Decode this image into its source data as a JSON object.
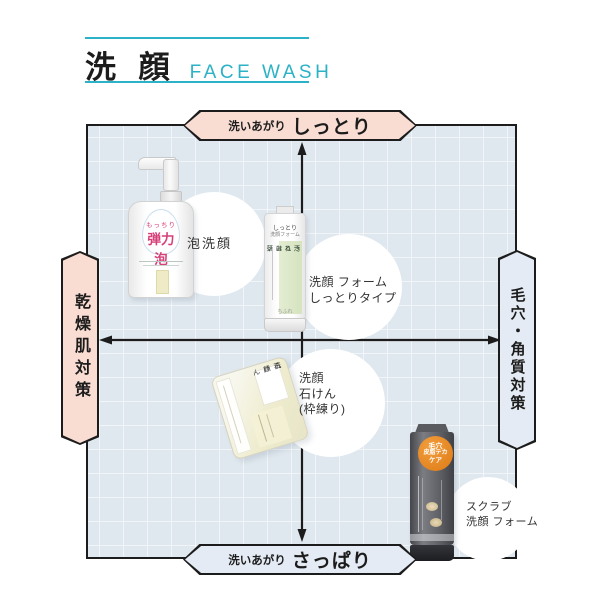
{
  "colors": {
    "accent_teal": "#2bb2c6",
    "banner_pink": "#f9dcd2",
    "banner_blue": "#e4ebf4",
    "grid_bg": "#e0e8ef",
    "ink": "#1c1c1c",
    "product_magenta": "#d64078",
    "tube_green": "#d5e3bf",
    "tube_dark": "#5a5c61",
    "badge_orange": "#e8882a"
  },
  "header": {
    "title_ja": "洗 顔",
    "title_en": "FACE WASH"
  },
  "quadrant": {
    "top": {
      "prefix": "洗いあがり",
      "label": "しっとり"
    },
    "bottom": {
      "prefix": "洗いあがり",
      "label": "さっぱり"
    },
    "left": {
      "label": "乾燥肌対策"
    },
    "right": {
      "label": "毛穴・角質対策"
    }
  },
  "products": [
    {
      "name": "foam-face-wash",
      "annotation": [
        "泡洗顔"
      ],
      "package": {
        "line_small": "もっちり",
        "line_big": "弾力泡"
      }
    },
    {
      "name": "face-wash-foam-moist-type",
      "annotation": [
        "洗顔 フォーム",
        "しっとりタイプ"
      ],
      "package": {
        "top1": "しっとり",
        "top2": "洗顔フォーム",
        "v1": "汚れは落として",
        "v2": "うるおい残す",
        "brand": "ちふれ"
      }
    },
    {
      "name": "face-wash-soap-kneaded",
      "annotation": [
        "洗顔",
        "石けん",
        "(枠練り)"
      ],
      "package": {
        "v1": "洗顔",
        "v2": "石けん"
      }
    },
    {
      "name": "scrub-face-wash-foam",
      "annotation": [
        "スクラブ",
        "洗顔 フォーム"
      ],
      "package": {
        "badge1": "毛穴",
        "badge2": "皮脂テカ",
        "badge3": "ケア"
      }
    }
  ]
}
